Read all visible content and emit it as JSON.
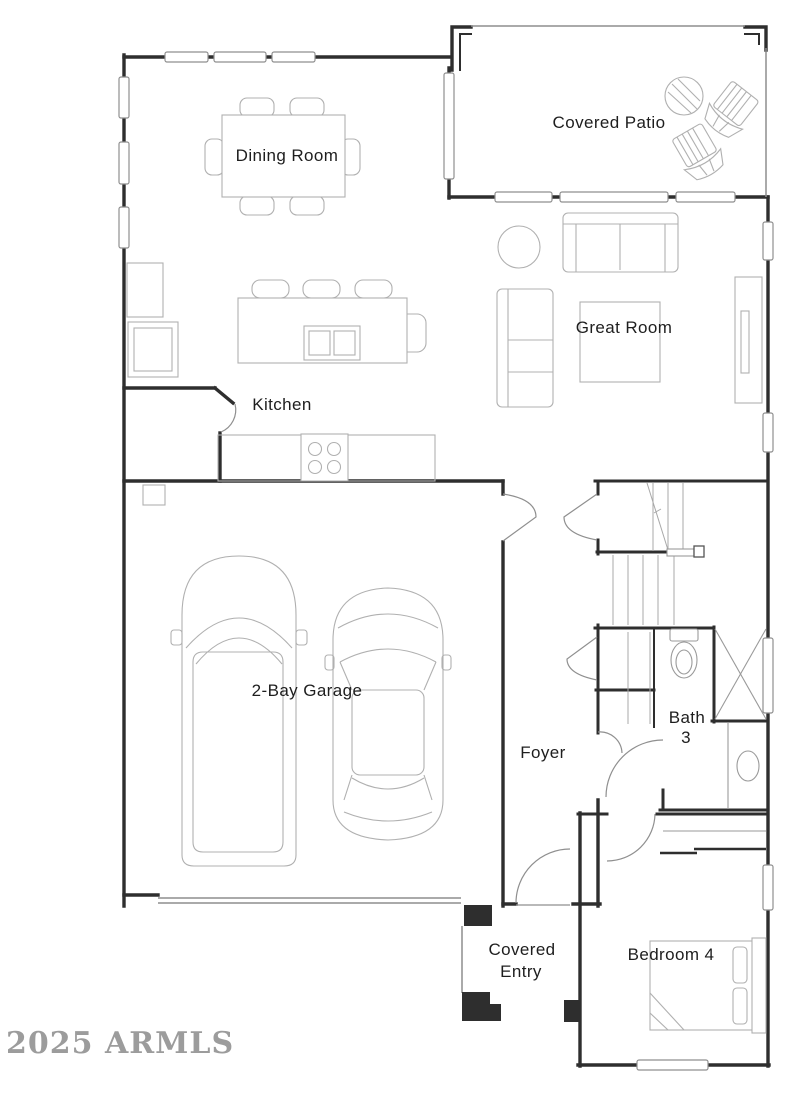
{
  "title": "Floor plan",
  "watermark": "2025 ARMLS",
  "rooms": {
    "dining": {
      "label": "Dining Room"
    },
    "patio": {
      "label": "Covered Patio"
    },
    "great": {
      "label": "Great Room"
    },
    "kitchen": {
      "label": "Kitchen"
    },
    "garage": {
      "label": "2-Bay Garage"
    },
    "foyer": {
      "label": "Foyer"
    },
    "bath": {
      "label_line1": "Bath",
      "label_line2": "3"
    },
    "bedroom": {
      "label": "Bedroom 4"
    },
    "entry": {
      "label_line1": "Covered",
      "label_line2": "Entry"
    }
  },
  "colors": {
    "wall": "#2e2e2e",
    "furniture_outline": "#b0b0b0",
    "window_border": "#8f8f8f",
    "label_text": "#1e1e1e",
    "watermark_text": "#9c9c9c",
    "background": "#ffffff"
  }
}
